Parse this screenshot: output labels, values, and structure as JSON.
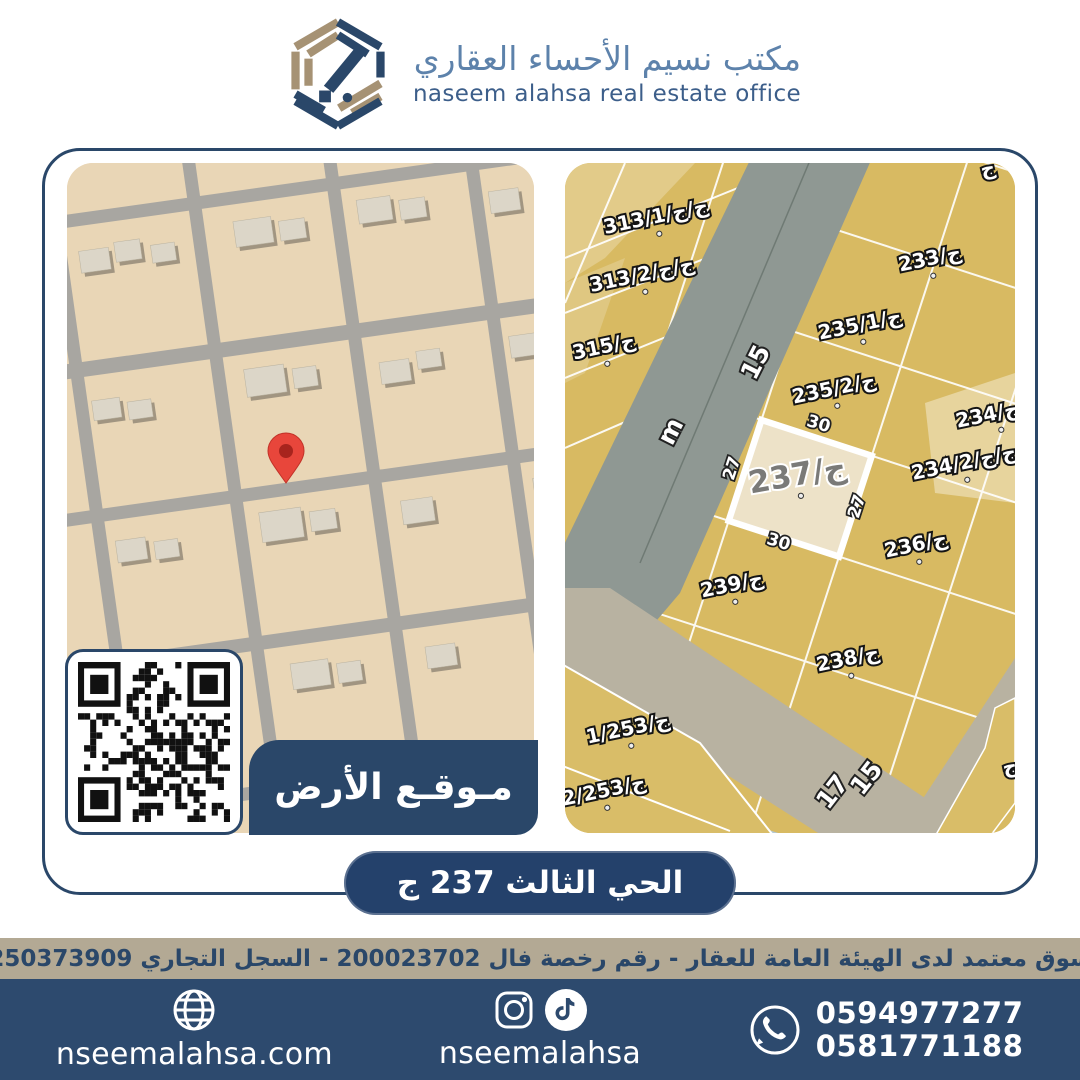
{
  "brand": {
    "title_ar": "مكتب نسيم الأحساء العقاري",
    "title_en": "naseem alahsa real estate office"
  },
  "location_label": "مـوقـع الأرض",
  "plot_banner": "الحي الثالث 237 ج",
  "accreditation_line": "مسوق معتمد لدى الهيئة العامة للعقار - رقم رخصة فال 200023702 - السجل التجاري 2250373909",
  "footer": {
    "website": "nseemalahsa.com",
    "social_handle": "nseemalahsa",
    "phones": [
      "0594977277",
      "0581771188"
    ],
    "icons": [
      "globe-icon",
      "instagram-icon",
      "tiktok-icon",
      "whatsapp-icon"
    ]
  },
  "colors": {
    "navy": "#2a4769",
    "navy_footer": "#2d4a6e",
    "tan_band": "#b3a994",
    "logo_tan": "#a69274",
    "brand_blue": "#5d82ab",
    "parcel_gold": "#d8ba62",
    "parcel_highlight": "#ede2c8",
    "pin_red": "#e8463b",
    "sat_sand": "#e9d6b6",
    "sat_road": "#a8a6a1"
  },
  "satellite_map": {
    "pin": "red-location-pin"
  },
  "parcel_map": {
    "plot_labels": [
      {
        "text": "ج/ج/313/1",
        "x": 92,
        "y": 60,
        "rot": -12
      },
      {
        "text": "ج/ج/313/2",
        "x": 78,
        "y": 118,
        "rot": -12
      },
      {
        "text": "ج/315",
        "x": 40,
        "y": 190,
        "rot": -12
      },
      {
        "text": "ج/233",
        "x": 366,
        "y": 102,
        "rot": -12
      },
      {
        "text": "ج/235/1",
        "x": 296,
        "y": 168,
        "rot": -12
      },
      {
        "text": "ج/235/2",
        "x": 270,
        "y": 232,
        "rot": -12
      },
      {
        "text": "ج/ج/234",
        "x": 434,
        "y": 256,
        "rot": -12
      },
      {
        "text": "ج/ج/234/2",
        "x": 400,
        "y": 306,
        "rot": -12
      },
      {
        "text": "ج/236",
        "x": 352,
        "y": 388,
        "rot": -12
      },
      {
        "text": "ج/239",
        "x": 168,
        "y": 428,
        "rot": -12
      },
      {
        "text": "ج/238",
        "x": 284,
        "y": 502,
        "rot": -12
      },
      {
        "text": "1/ج/253",
        "x": 64,
        "y": 572,
        "rot": -12
      },
      {
        "text": "2/ج/253",
        "x": 40,
        "y": 634,
        "rot": -12
      },
      {
        "text": "ج",
        "x": 424,
        "y": 12,
        "rot": -12,
        "dot": false
      },
      {
        "text": "ج",
        "x": 446,
        "y": 610,
        "rot": -12,
        "dot": false
      }
    ],
    "highlight_label": {
      "text": "ج/237",
      "x": 234,
      "y": 322,
      "rot": -10
    },
    "dimension_labels": [
      {
        "text": "30",
        "x": 252,
        "y": 266,
        "rot": 17
      },
      {
        "text": "27",
        "x": 172,
        "y": 307,
        "rot": -72
      },
      {
        "text": "27",
        "x": 297,
        "y": 345,
        "rot": -72
      },
      {
        "text": "30",
        "x": 212,
        "y": 384,
        "rot": 17
      }
    ],
    "street_labels": [
      {
        "text": "15",
        "x": 198,
        "y": 203,
        "rot": -63
      },
      {
        "text": "m",
        "x": 113,
        "y": 272,
        "rot": -63
      },
      {
        "text": "17",
        "x": 274,
        "y": 634,
        "rot": -52
      },
      {
        "text": "15",
        "x": 308,
        "y": 620,
        "rot": -52
      }
    ]
  }
}
